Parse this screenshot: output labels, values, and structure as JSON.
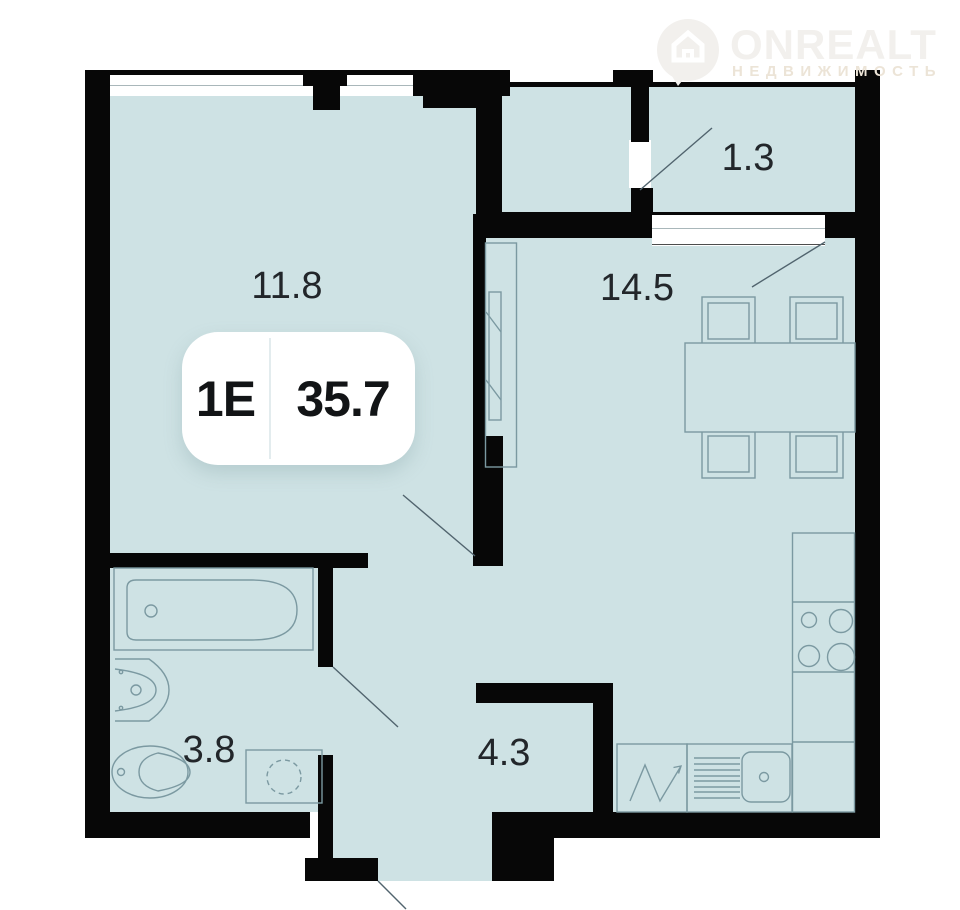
{
  "logo": {
    "brand": "ONREALT",
    "subtitle": "НЕДВИЖИМОСТЬ"
  },
  "plan": {
    "unit": {
      "type_label": "1Е",
      "total_area": "35.7"
    },
    "rooms": [
      {
        "id": "living-room",
        "area_label": "11.8"
      },
      {
        "id": "kitchen-living",
        "area_label": "14.5"
      },
      {
        "id": "balcony",
        "area_label": "1.3"
      },
      {
        "id": "bathroom",
        "area_label": "3.8"
      },
      {
        "id": "hallway",
        "area_label": "4.3"
      }
    ],
    "icons": [
      "house-pin-icon",
      "bathtub-icon",
      "washbasin-icon",
      "toilet-icon",
      "washing-machine-icon",
      "dining-table-icon",
      "chair-icon",
      "stove-icon",
      "sink-icon",
      "wardrobe-icon",
      "door-swing-icon"
    ],
    "colors": {
      "floor_fill": "#cee2e4",
      "wall": "#070707",
      "furniture_line": "#7b99a1",
      "door_line": "#51646e",
      "label_text": "#22262a",
      "logo_main": "#f2f0ed",
      "logo_sub": "#ece4d7"
    }
  }
}
